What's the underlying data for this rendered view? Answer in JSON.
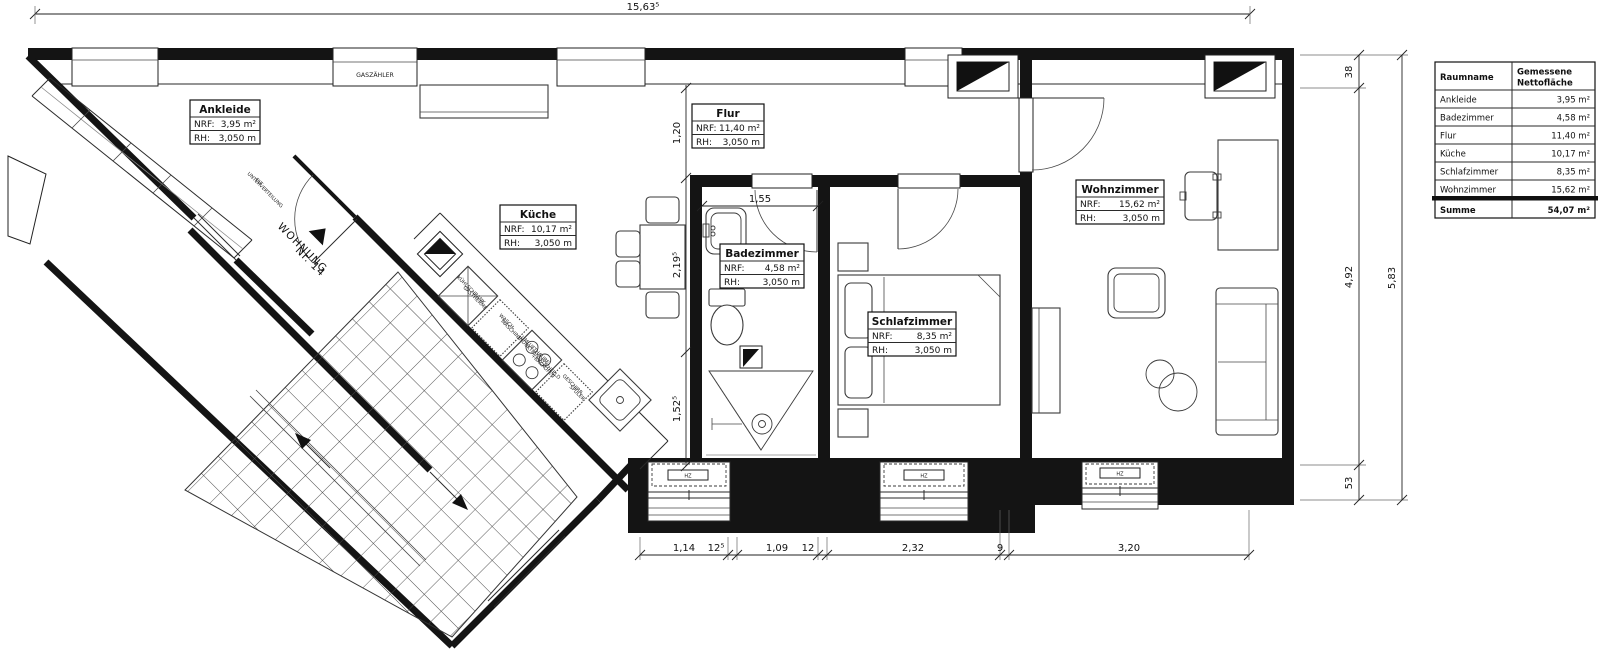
{
  "title": "Wohnung Nr. 14 Grundriss",
  "dims": {
    "top": "15,63⁵",
    "right": [
      "38",
      "4,92",
      "53",
      "5,83"
    ],
    "bottom": [
      "1,14",
      "12⁵",
      "1,09",
      "12",
      "2,32",
      "9",
      "3,20"
    ],
    "interior": {
      "flur": "1,20",
      "bad": "1,55",
      "kueche_mid": "2,19⁵",
      "kueche_low": "1,52⁵"
    }
  },
  "rooms": [
    {
      "name": "Ankleide",
      "nrf_label": "NRF:",
      "nrf": "3,95 m²",
      "rh_label": "RH:",
      "rh": "3,050 m"
    },
    {
      "name": "Flur",
      "nrf_label": "NRF:",
      "nrf": "11,40 m²",
      "rh_label": "RH:",
      "rh": "3,050 m"
    },
    {
      "name": "Küche",
      "nrf_label": "NRF:",
      "nrf": "10,17 m²",
      "rh_label": "RH:",
      "rh": "3,050 m"
    },
    {
      "name": "Badezimmer",
      "nrf_label": "NRF:",
      "nrf": "4,58 m²",
      "rh_label": "RH:",
      "rh": "3,050 m"
    },
    {
      "name": "Schlafzimmer",
      "nrf_label": "NRF:",
      "nrf": "8,35 m²",
      "rh_label": "RH:",
      "rh": "3,050 m"
    },
    {
      "name": "Wohnzimmer",
      "nrf_label": "NRF:",
      "nrf": "15,62 m²",
      "rh_label": "RH:",
      "rh": "3,050 m"
    }
  ],
  "labels": {
    "gas": "GASZÄHLER",
    "elt1": "ELT",
    "elt2": "UNTERVERTEILUNG",
    "wohnung1": "WOHNUNG",
    "wohnung2": "Nr. 14",
    "fridge1": "KÜHLSCHRANK",
    "fridge2": "GASTHERME",
    "washer1": "WASCH-",
    "washer2": "MASCHINE",
    "hood1": "UMLUFTHAUBE",
    "hood2": "INDUKTIONSKOCHFELD",
    "hood3": "+BACKOFEN",
    "dish1": "GESCHIRR-",
    "dish2": "SPÜLER",
    "hz": "HZ"
  },
  "table": {
    "headers": [
      "Raumname",
      "Gemessene",
      "Nettofläche"
    ],
    "rows": [
      [
        "Ankleide",
        "3,95 m²"
      ],
      [
        "Badezimmer",
        "4,58 m²"
      ],
      [
        "Flur",
        "11,40 m²"
      ],
      [
        "Küche",
        "10,17 m²"
      ],
      [
        "Schlafzimmer",
        "8,35 m²"
      ],
      [
        "Wohnzimmer",
        "15,62 m²"
      ]
    ],
    "total": [
      "Summe",
      "54,07 m²"
    ]
  }
}
